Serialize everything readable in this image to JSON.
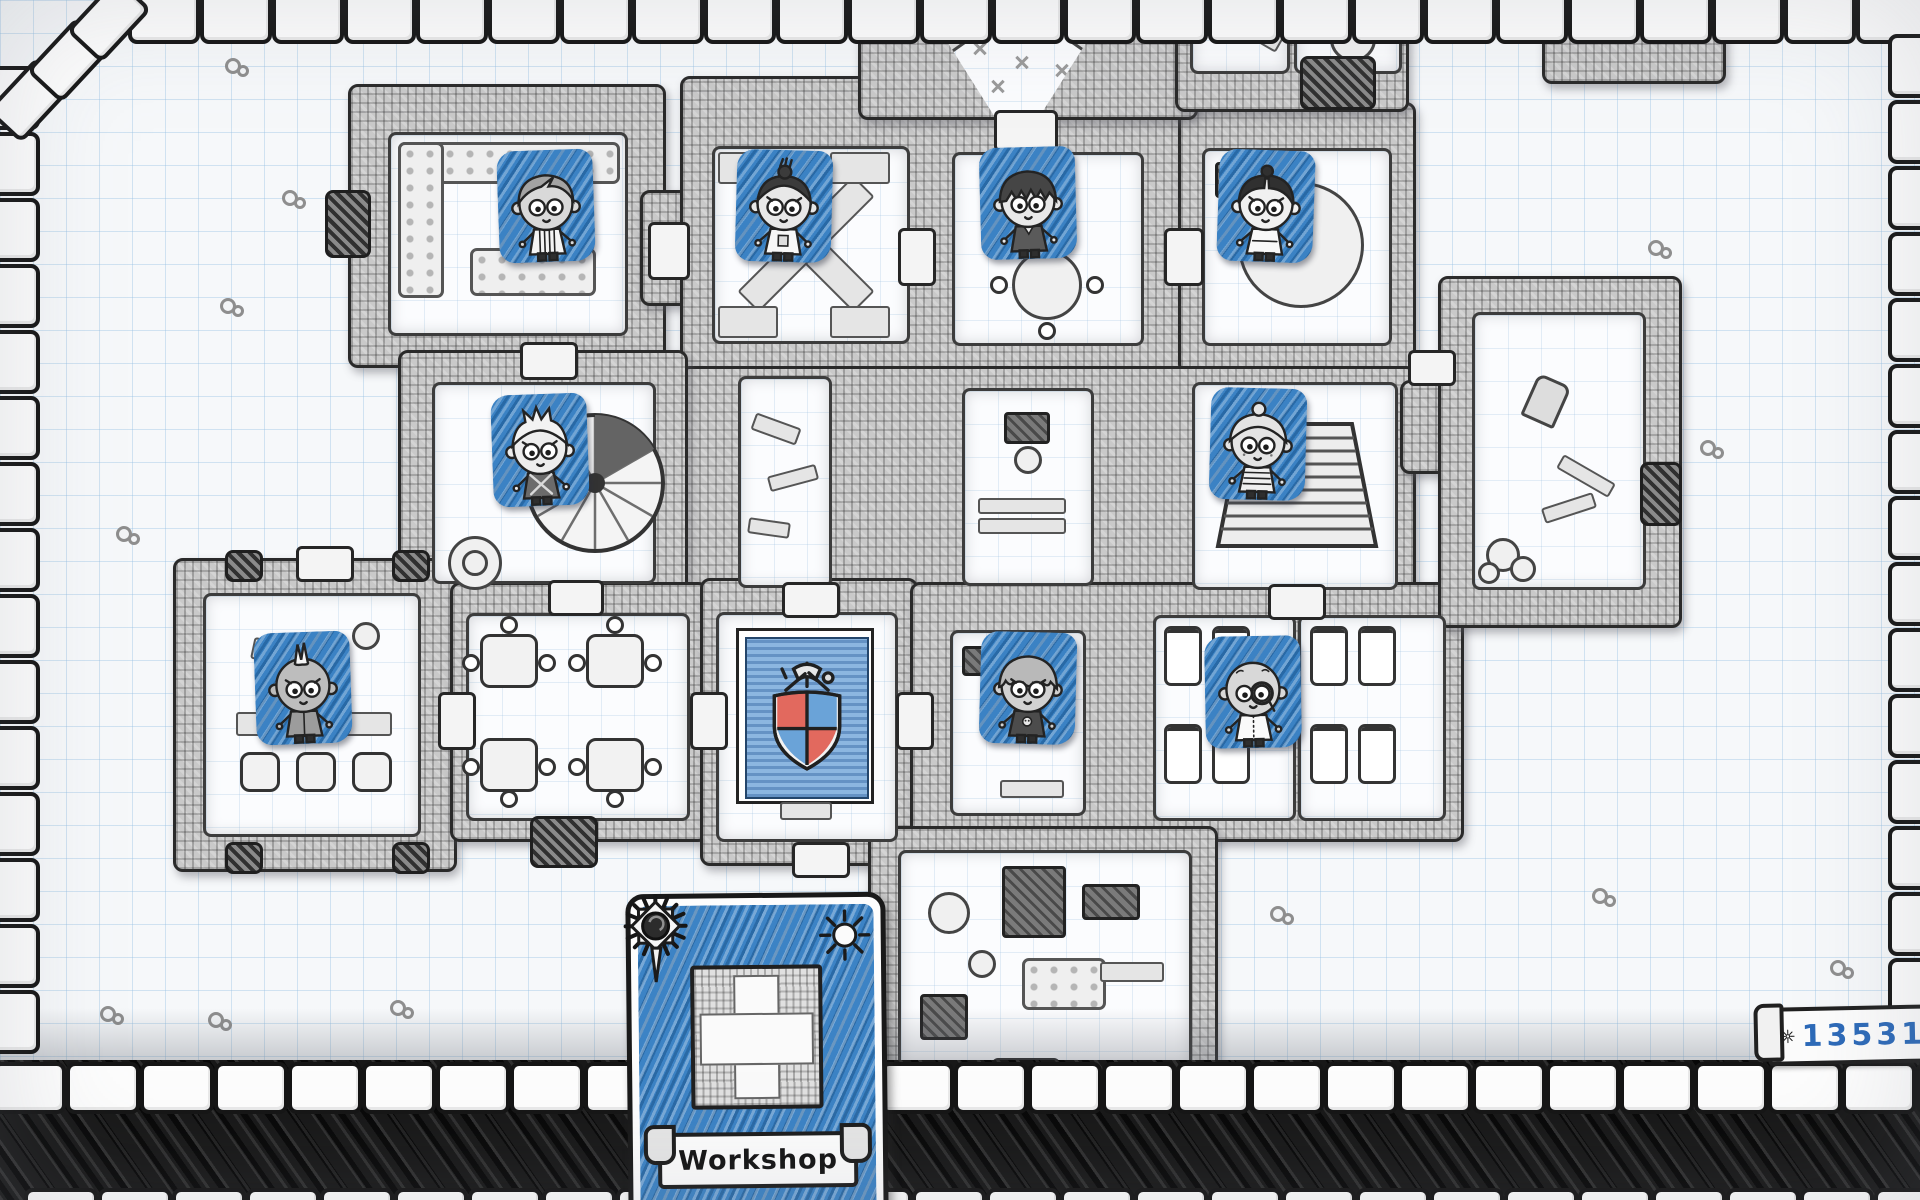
{
  "hud": {
    "gold": "13531",
    "gold_icon": "sunburst-icon"
  },
  "blueprint_card": {
    "label": "Workshop",
    "corner_icons": [
      "dark-sun-icon",
      "light-sun-icon"
    ],
    "thumbnail": "room-sketch-thumbnail"
  },
  "crest": {
    "icon": "guild-crest-shield",
    "quarter_colors": [
      "#e2695e",
      "#6aa3d8",
      "#6aa3d8",
      "#e2695e"
    ]
  },
  "colors": {
    "tile_blue": "#3b82c4",
    "ink": "#232323",
    "paper": "#f6f8fa",
    "grid_line": "#cfe2f0",
    "banner_blue": "#8cb6e0",
    "gold_text": "#2d6ab8"
  },
  "characters": [
    {
      "id": "hero-1",
      "hair": "side-part",
      "skin": "#d9d9d9",
      "outfit": "striped-robe",
      "x": 546,
      "y": 206,
      "tilt": -2
    },
    {
      "id": "hero-2",
      "hair": "topknot",
      "skin": "#e8e8e8",
      "outfit": "graphic-tee",
      "x": 784,
      "y": 206,
      "tilt": 1.5
    },
    {
      "id": "hero-3",
      "hair": "shaggy",
      "skin": "#e8e8e8",
      "outfit": "dark-suit",
      "x": 1028,
      "y": 203,
      "tilt": -1.5
    },
    {
      "id": "hero-4",
      "hair": "middle-bun",
      "skin": "#f0f0f0",
      "outfit": "white-robe",
      "x": 1266,
      "y": 206,
      "tilt": 2
    },
    {
      "id": "hero-5",
      "hair": "spiky-white",
      "skin": "#ededed",
      "outfit": "strap-vest",
      "x": 540,
      "y": 450,
      "tilt": -2
    },
    {
      "id": "hero-6",
      "hair": "granny-bun",
      "skin": "#e4e4e4",
      "outfit": "striped-sweater",
      "x": 1258,
      "y": 444,
      "tilt": 1.5
    },
    {
      "id": "hero-7",
      "hair": "mohawk",
      "skin": "#bdbdbd",
      "outfit": "grey-vest",
      "x": 303,
      "y": 688,
      "tilt": -2
    },
    {
      "id": "hero-8",
      "hair": "scalloped-bob",
      "skin": "#d2d2d2",
      "outfit": "skull-shirt",
      "x": 1028,
      "y": 688,
      "tilt": 1.5
    },
    {
      "id": "hero-9",
      "hair": "bald-monocle",
      "skin": "#d8d8d8",
      "outfit": "white-shirt",
      "x": 1253,
      "y": 692,
      "tilt": -1
    }
  ]
}
